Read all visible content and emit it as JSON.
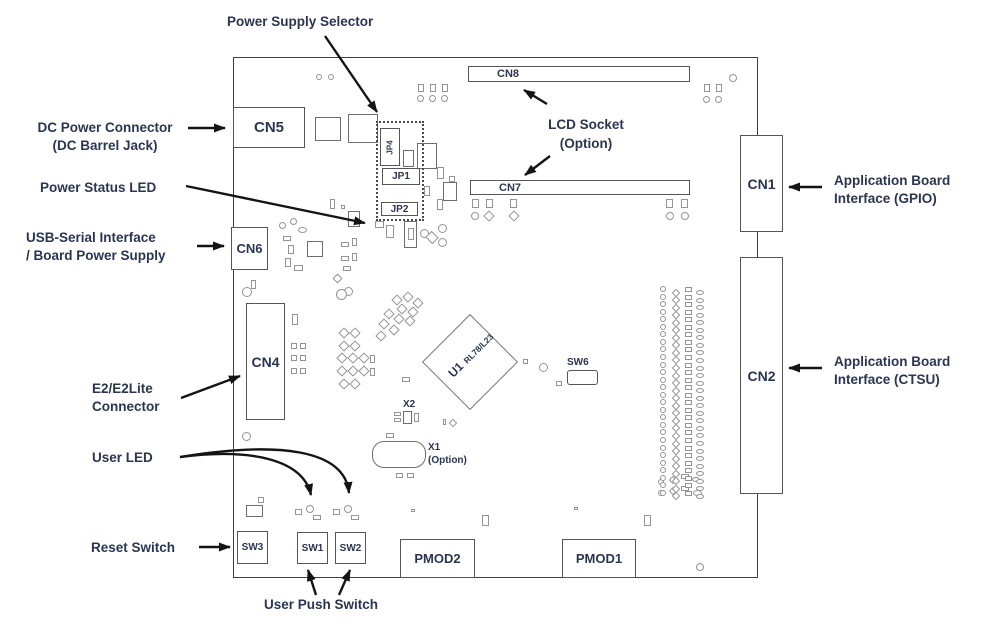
{
  "annotations": {
    "power_supply_selector": "Power Supply Selector",
    "dc_power_connector": {
      "line1": "DC Power Connector",
      "line2": "(DC Barrel Jack)"
    },
    "power_status_led": "Power Status LED",
    "usb_serial": {
      "line1": "USB-Serial Interface",
      "line2": "/ Board Power Supply"
    },
    "e2_connector": {
      "line1": "E2/E2Lite",
      "line2": "Connector"
    },
    "user_led": "User LED",
    "reset_switch": "Reset Switch",
    "user_push_switch": "User Push Switch",
    "lcd_socket": {
      "line1": "LCD Socket",
      "line2": "(Option)"
    },
    "app_board_gpio": {
      "line1": "Application Board",
      "line2": "Interface (GPIO)"
    },
    "app_board_ctsu": {
      "line1": "Application Board",
      "line2": "Interface (CTSU)"
    }
  },
  "components": {
    "cn1": "CN1",
    "cn2": "CN2",
    "cn4": "CN4",
    "cn5": "CN5",
    "cn6": "CN6",
    "cn7": "CN7",
    "cn8": "CN8",
    "jp1": "JP1",
    "jp2": "JP2",
    "jp4": "JP4",
    "sw1": "SW1",
    "sw2": "SW2",
    "sw3": "SW3",
    "sw6": "SW6",
    "pmod1": "PMOD1",
    "pmod2": "PMOD2",
    "u1": {
      "ref": "U1",
      "part": "RL78/L23"
    },
    "x1": {
      "ref": "X1",
      "note": "(Option)"
    },
    "x2": "X2"
  },
  "colors": {
    "label_text": "#2a3550",
    "board_outline": "#3f3f3f",
    "component_outline": "#6e6e6e",
    "pad_outline": "#949494",
    "arrow": "#141414",
    "background": "#ffffff"
  }
}
